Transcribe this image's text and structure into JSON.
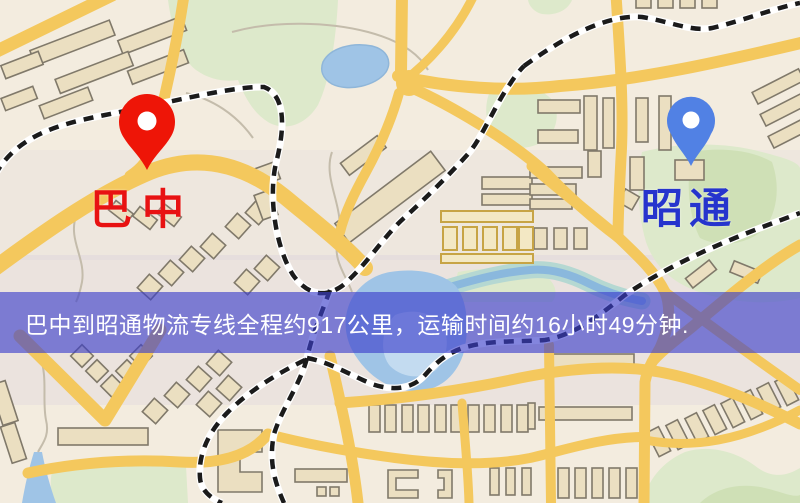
{
  "banner": {
    "text": "巴中到昭通物流专线全程约917公里，运输时间约16小时49分钟."
  },
  "markers": {
    "origin": {
      "label": "巴中"
    },
    "destination": {
      "label": "昭通"
    }
  },
  "colors": {
    "banner-bg": "rgba(59,61,203,0.63)",
    "banner-text": "#ffffff",
    "label-origin": "#e81212",
    "label-dest": "#2634cd",
    "pin-origin": "#ee1507",
    "pin-dest": "#5181e4",
    "road": "#f4c85d",
    "building": "#ebdfc1",
    "building-line": "#80796a",
    "park": "#dde9cb",
    "park-dark": "#cfe0b6",
    "water": "#9fc4e6",
    "water-light": "#c3dbf0",
    "rail-dark": "#1b1b1b"
  }
}
